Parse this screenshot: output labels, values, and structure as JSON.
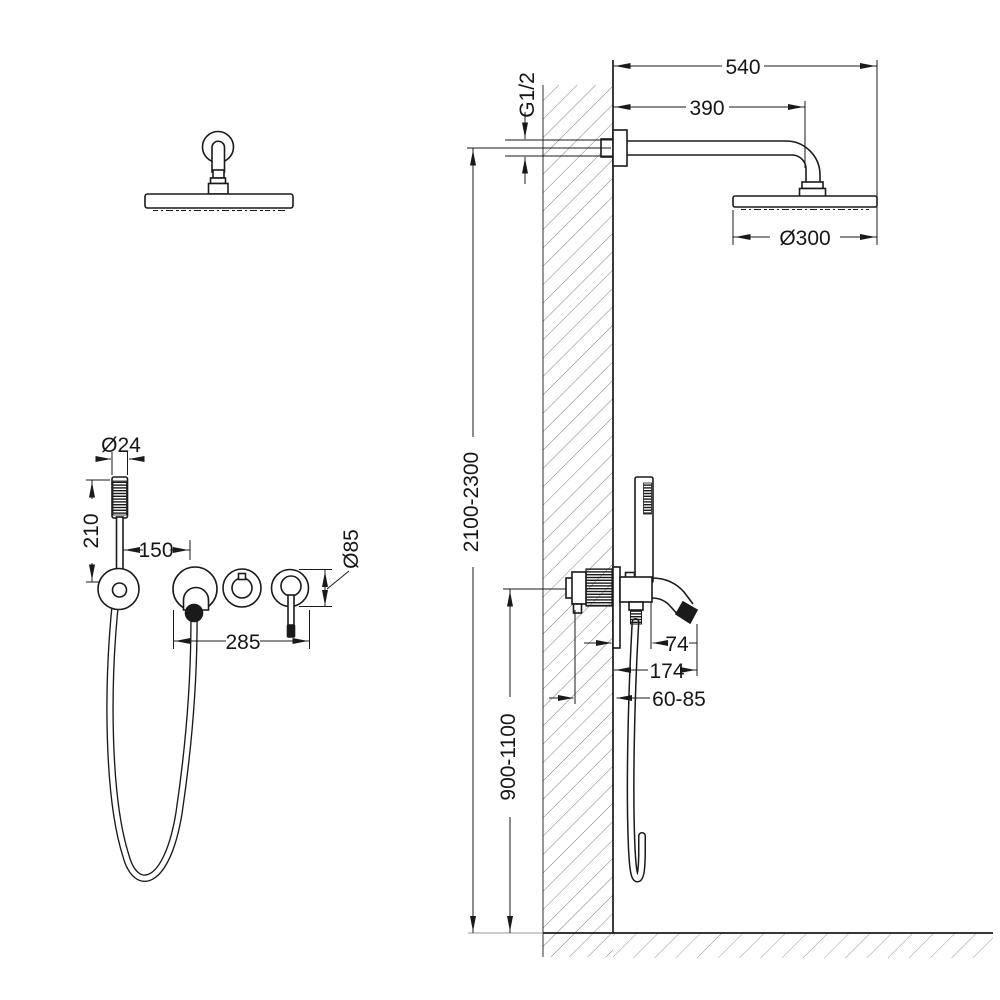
{
  "drawing": {
    "type": "shower-system-installation-diagram",
    "colors": {
      "ink": "#1a1a1a",
      "wall_hatch": "#7d7d7d",
      "floor_hatch": "#8c8c8c",
      "background": "#ffffff"
    },
    "front_view": {
      "dimensions": {
        "handshower_diameter": "Ø24",
        "handshower_height": "210",
        "holder_to_mixer": "150",
        "mixer_width": "285",
        "trim_diameter": "Ø85"
      }
    },
    "side_view": {
      "dimensions": {
        "connection_thread": "G1/2",
        "arm_overall": "540",
        "arm_projection": "390",
        "head_diameter": "Ø300",
        "install_height": "2100-2300",
        "mixer_height": "900-1100",
        "spout_offset": "74",
        "spout_projection": "174",
        "rough_in_depth": "60-85"
      }
    }
  }
}
